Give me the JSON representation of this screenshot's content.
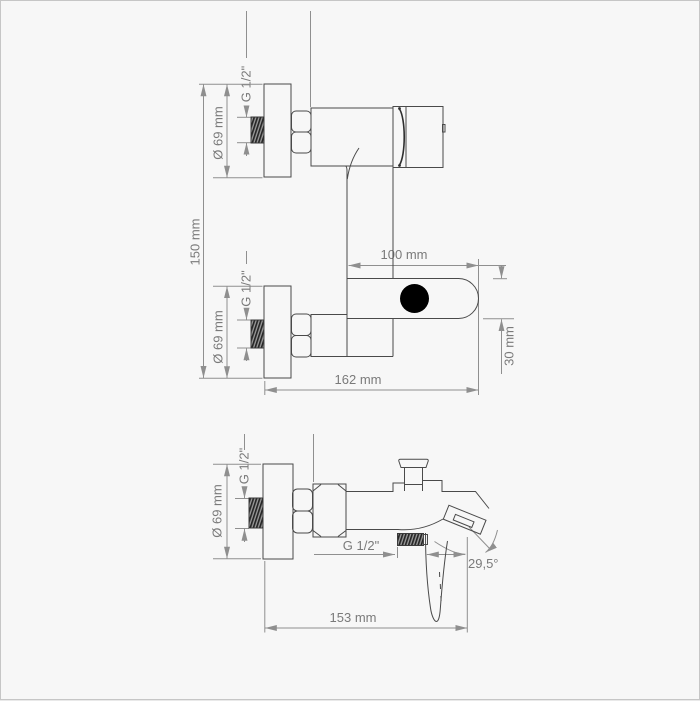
{
  "drawing": {
    "title": "wall-mounted bath mixer dimensional drawing",
    "background": "#f7f7f7",
    "border_color": "#c6c6c6",
    "outline_color": "#4a4a4a",
    "dimension_color": "#8f8f8f",
    "text_color": "#7a7a7a",
    "views": {
      "plan": {
        "labels": {
          "upper_thread": "G 1/2\"",
          "upper_plate_diameter": "Ø 69 mm",
          "connection_distance": "150 mm",
          "spout_length": "100 mm",
          "spout_height": "30 mm",
          "overall_depth": "162 mm",
          "lower_thread": "G 1/2\"",
          "lower_plate_diameter": "Ø 69 mm"
        }
      },
      "side": {
        "labels": {
          "wall_thread": "G 1/2\"",
          "plate_diameter": "Ø 69 mm",
          "outlet_thread": "G 1/2\"",
          "spout_angle": "29,5°",
          "overall_length": "153 mm"
        }
      }
    }
  }
}
